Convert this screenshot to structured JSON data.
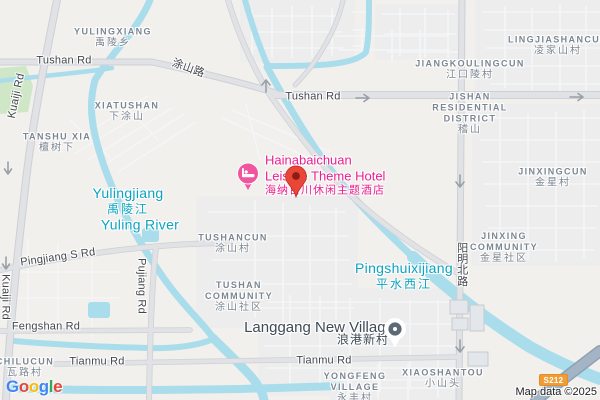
{
  "map": {
    "attribution": {
      "text": "Map data ©2025"
    },
    "route_badge": {
      "text": "S212",
      "color": "#f09d36"
    },
    "logo": {
      "name": "Google",
      "letters": [
        {
          "ch": "G",
          "c": "#4285F4"
        },
        {
          "ch": "o",
          "c": "#EA4335"
        },
        {
          "ch": "o",
          "c": "#FBBC05"
        },
        {
          "ch": "g",
          "c": "#4285F4"
        },
        {
          "ch": "l",
          "c": "#34A853"
        },
        {
          "ch": "e",
          "c": "#EA4335"
        }
      ]
    },
    "markers": {
      "destination_pin": {
        "title": "Hainabaichuan Leisure Theme Hotel",
        "color": "#e94638"
      },
      "hotel_icon": {
        "type": "lodging",
        "color": "#f0569f"
      },
      "village_poi": {
        "title": "Langgang New Village",
        "color": "#5c6a77"
      }
    },
    "labels": [
      {
        "id": "yulingxiang",
        "kind": "area",
        "x": 113,
        "y": 38,
        "lines": [
          {
            "t": "YULINGXIANG"
          },
          {
            "t": "禹陵乡",
            "zh": true
          }
        ]
      },
      {
        "id": "xiatushan",
        "kind": "area",
        "x": 127,
        "y": 112,
        "lines": [
          {
            "t": "XIATUSHAN"
          },
          {
            "t": "下涂山",
            "zh": true
          }
        ]
      },
      {
        "id": "tanshu-xia",
        "kind": "area",
        "x": 57,
        "y": 143,
        "lines": [
          {
            "t": "TANSHU XIA"
          },
          {
            "t": "檀树下",
            "zh": true
          }
        ]
      },
      {
        "id": "lingjiashancun",
        "kind": "area",
        "x": 558,
        "y": 46,
        "lines": [
          {
            "t": "LINGJIASHANCUN"
          },
          {
            "t": "凌家山村",
            "zh": true
          }
        ]
      },
      {
        "id": "jiangkoulingcun",
        "kind": "area",
        "x": 470,
        "y": 70,
        "lines": [
          {
            "t": "JIANGKOULINGCUN"
          },
          {
            "t": "江口陵村",
            "zh": true
          }
        ]
      },
      {
        "id": "jishan-residential-district",
        "kind": "area",
        "x": 470,
        "y": 114,
        "lines": [
          {
            "t": "JISHAN"
          },
          {
            "t": "RESIDENTIAL"
          },
          {
            "t": "DISTRICT"
          },
          {
            "t": "稽山",
            "zh": true
          }
        ]
      },
      {
        "id": "jinxingcun",
        "kind": "area",
        "x": 553,
        "y": 178,
        "lines": [
          {
            "t": "JINXINGCUN"
          },
          {
            "t": "金星村",
            "zh": true
          }
        ]
      },
      {
        "id": "jinxing-community",
        "kind": "area",
        "x": 504,
        "y": 248,
        "lines": [
          {
            "t": "JINXING"
          },
          {
            "t": "COMMUNITY"
          },
          {
            "t": "金星社区",
            "zh": true
          }
        ]
      },
      {
        "id": "tushancun",
        "kind": "area",
        "x": 233,
        "y": 244,
        "lines": [
          {
            "t": "TUSHANCUN"
          },
          {
            "t": "涂山村",
            "zh": true
          }
        ]
      },
      {
        "id": "tushan-community",
        "kind": "area",
        "x": 239,
        "y": 297,
        "lines": [
          {
            "t": "TUSHAN"
          },
          {
            "t": "COMMUNITY"
          },
          {
            "t": "涂山社区",
            "zh": true
          }
        ]
      },
      {
        "id": "chilucun",
        "kind": "area",
        "x": 25,
        "y": 368,
        "lines": [
          {
            "t": "CHILUCUN"
          },
          {
            "t": "瓦路村",
            "zh": true
          }
        ]
      },
      {
        "id": "yongfeng-village",
        "kind": "area",
        "x": 355,
        "y": 388,
        "lines": [
          {
            "t": "YONGFENG"
          },
          {
            "t": "VILLAGE"
          },
          {
            "t": "永丰村",
            "zh": true
          }
        ]
      },
      {
        "id": "xiaoshantou",
        "kind": "area",
        "x": 443,
        "y": 379,
        "lines": [
          {
            "t": "XIAOSHANTOU"
          },
          {
            "t": "小山头",
            "zh": true
          }
        ]
      },
      {
        "id": "yulingjiang",
        "kind": "water",
        "x": 128,
        "y": 201,
        "lines": [
          {
            "t": "Yulingjiang"
          },
          {
            "t": "禹陵江",
            "zh": true
          }
        ]
      },
      {
        "id": "yuling-river",
        "kind": "water",
        "x": 140,
        "y": 225,
        "lines": [
          {
            "t": "Yuling River"
          }
        ]
      },
      {
        "id": "pingshuixijiang",
        "kind": "water",
        "x": 404,
        "y": 276,
        "lines": [
          {
            "t": "Pingshuixijiang"
          },
          {
            "t": "平水西江",
            "zh": true
          }
        ]
      },
      {
        "id": "hainabaichuan-hotel",
        "kind": "hotel",
        "x": 265,
        "y": 175,
        "anchor": "l",
        "lines": [
          {
            "t": "Hainabaichuan"
          },
          {
            "t": "Leisure Theme Hotel"
          },
          {
            "t": "海纳百川休闲主题酒店",
            "zh": true
          }
        ]
      },
      {
        "id": "langgang-new-village",
        "kind": "poi",
        "x": 319,
        "y": 328,
        "lines": [
          {
            "t": "Langgang New Village"
          }
        ]
      },
      {
        "id": "langgang-new-village-zh",
        "kind": "poi",
        "x": 363,
        "y": 340,
        "lines": [
          {
            "t": "浪港新村",
            "zh": true
          }
        ]
      },
      {
        "id": "tushan-rd-west",
        "kind": "road",
        "x": 64,
        "y": 61,
        "lines": [
          {
            "t": "Tushan Rd"
          }
        ]
      },
      {
        "id": "tushan-lu",
        "kind": "road",
        "x": 188,
        "y": 69,
        "rot": 20,
        "lines": [
          {
            "t": "涂山路",
            "zh": true
          }
        ]
      },
      {
        "id": "tushan-rd-east",
        "kind": "road",
        "x": 313,
        "y": 97,
        "lines": [
          {
            "t": "Tushan Rd"
          }
        ]
      },
      {
        "id": "kuaiji-rd-north",
        "kind": "road",
        "x": 17,
        "y": 96,
        "rot": -78,
        "lines": [
          {
            "t": "Kuaiji Rd"
          }
        ]
      },
      {
        "id": "kuaiji-rd-south",
        "kind": "road",
        "x": 5,
        "y": 297,
        "rot": 90,
        "lines": [
          {
            "t": "Kuaiji Rd"
          }
        ]
      },
      {
        "id": "pingjiang-s-rd",
        "kind": "road",
        "x": 58,
        "y": 258,
        "rot": -8,
        "lines": [
          {
            "t": "Pingjiang S Rd"
          }
        ]
      },
      {
        "id": "pujiang-rd",
        "kind": "road",
        "x": 141,
        "y": 286,
        "rot": 90,
        "lines": [
          {
            "t": "Pujiang Rd"
          }
        ]
      },
      {
        "id": "fengshan-rd",
        "kind": "road",
        "x": 46,
        "y": 327,
        "lines": [
          {
            "t": "Fengshan Rd"
          }
        ]
      },
      {
        "id": "tianmu-rd-west",
        "kind": "road",
        "x": 97,
        "y": 362,
        "lines": [
          {
            "t": "Tianmu Rd"
          }
        ]
      },
      {
        "id": "tianmu-rd-east",
        "kind": "road",
        "x": 324,
        "y": 361,
        "lines": [
          {
            "t": "Tianmu Rd"
          }
        ]
      },
      {
        "id": "yangming-north-rd",
        "kind": "road",
        "x": 461,
        "y": 264,
        "vertical": true,
        "lines": [
          {
            "t": "阳明北路",
            "zh": true
          }
        ]
      }
    ]
  }
}
